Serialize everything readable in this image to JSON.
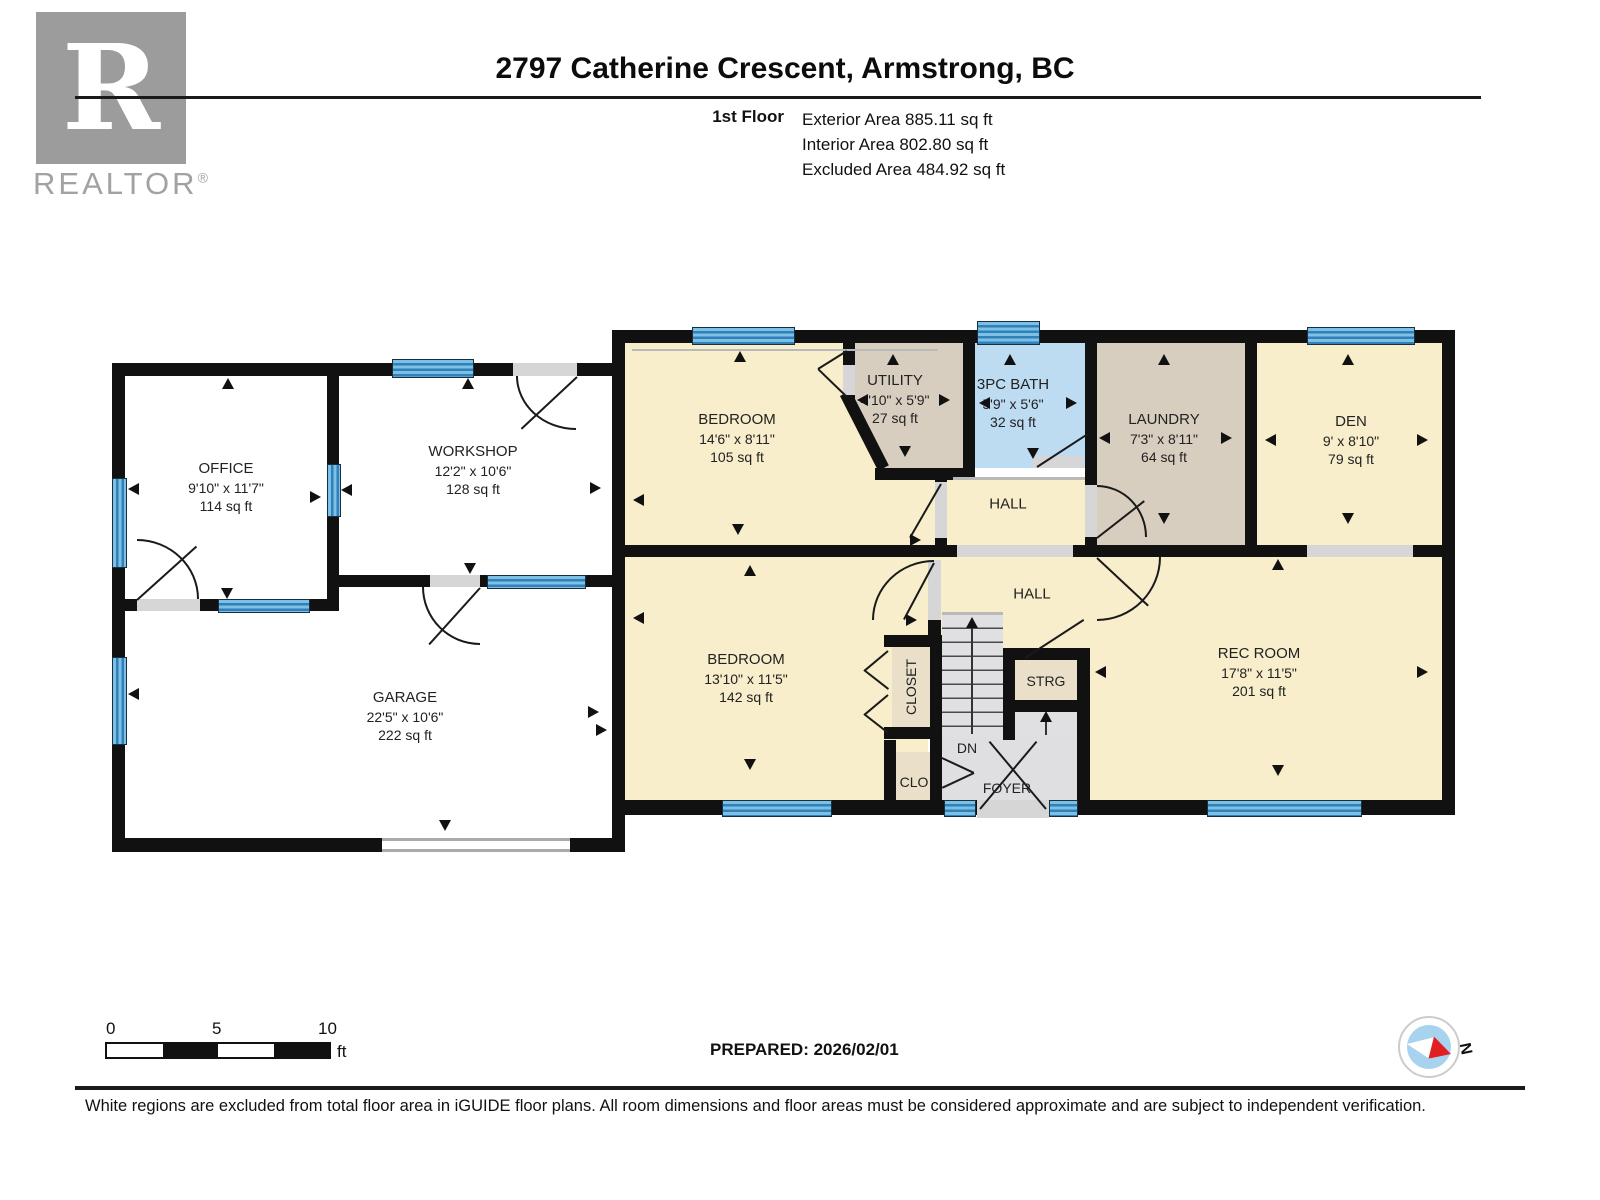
{
  "header": {
    "title": "2797 Catherine Crescent, Armstrong, BC",
    "floor_label": "1st Floor",
    "exterior_area": "Exterior Area 885.11 sq ft",
    "interior_area": "Interior Area 802.80 sq ft",
    "excluded_area": "Excluded Area 484.92 sq ft"
  },
  "logo": {
    "letter": "R",
    "label": "REALTOR",
    "registered": "®"
  },
  "rooms": {
    "office": {
      "name": "OFFICE",
      "dims": "9'10\" x 11'7\"",
      "area": "114 sq ft"
    },
    "workshop": {
      "name": "WORKSHOP",
      "dims": "12'2\" x 10'6\"",
      "area": "128 sq ft"
    },
    "garage": {
      "name": "GARAGE",
      "dims": "22'5\" x 10'6\"",
      "area": "222 sq ft"
    },
    "bedroom1": {
      "name": "BEDROOM",
      "dims": "14'6\" x 8'11\"",
      "area": "105 sq ft"
    },
    "utility": {
      "name": "UTILITY",
      "dims": "4'10\" x 5'9\"",
      "area": "27 sq ft"
    },
    "bath": {
      "name": "3PC BATH",
      "dims": "5'9\" x 5'6\"",
      "area": "32 sq ft"
    },
    "laundry": {
      "name": "LAUNDRY",
      "dims": "7'3\" x 8'11\"",
      "area": "64 sq ft"
    },
    "den": {
      "name": "DEN",
      "dims": "9' x 8'10\"",
      "area": "79 sq ft"
    },
    "hall_upper": {
      "name": "HALL"
    },
    "hall_lower": {
      "name": "HALL"
    },
    "bedroom2": {
      "name": "BEDROOM",
      "dims": "13'10\" x 11'5\"",
      "area": "142 sq ft"
    },
    "rec_room": {
      "name": "REC ROOM",
      "dims": "17'8\" x 11'5\"",
      "area": "201 sq ft"
    },
    "closet": {
      "name": "CLOSET"
    },
    "strg": {
      "name": "STRG"
    },
    "clo": {
      "name": "CLO"
    },
    "foyer": {
      "name": "FOYER"
    },
    "stairs": {
      "name": "DN"
    }
  },
  "footer": {
    "scale_ticks": [
      "0",
      "5",
      "10"
    ],
    "scale_unit": "ft",
    "prepared": "PREPARED: 2026/02/01",
    "compass": "N",
    "disclaimer": "White regions are excluded from total floor area in iGUIDE floor plans. All room dimensions and floor areas must be considered approximate and are subject to independent verification."
  },
  "colors": {
    "interior": "#f8eecb",
    "service": "#d8cec0",
    "closet_fill": "#eadfc9",
    "bath": "#bddcf2",
    "stairs": "#dfdfe1",
    "window": "#3180b8",
    "wall": "#111111",
    "excluded": "#ffffff",
    "compass_needle": "#e02020"
  }
}
